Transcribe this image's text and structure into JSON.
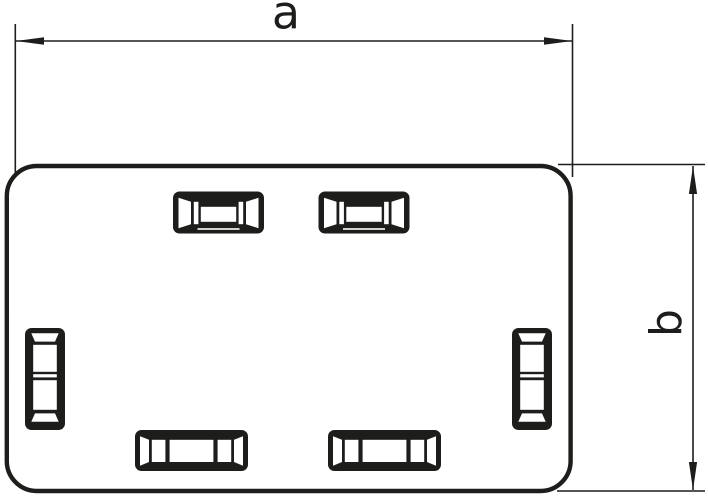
{
  "figure": {
    "type": "technical-line-drawing",
    "background_color": "#ffffff",
    "line_color": "#1d1d1b",
    "part": {
      "shape": "rounded-rectangle cover plate",
      "latch_slots_top": 2,
      "latch_slots_bottom": 2,
      "latch_slots_sides": 2
    },
    "dimensions": [
      {
        "label": "a",
        "orientation": "horizontal",
        "extent": "overall width"
      },
      {
        "label": "b",
        "orientation": "vertical",
        "extent": "overall height"
      }
    ]
  }
}
